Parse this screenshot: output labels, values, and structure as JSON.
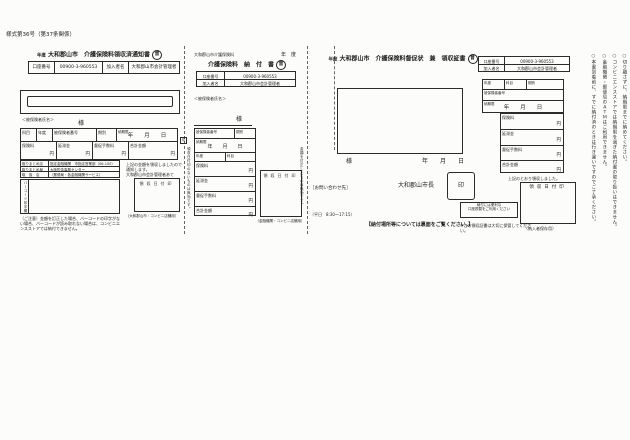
{
  "page": {
    "form_number": "様式第36号（第37条関係）"
  },
  "shared": {
    "account_label": "口座番号",
    "account_number": "00900-3-960553",
    "member_label": "加入者名",
    "member_name": "大和郡山市会計管理者",
    "insured_name_hint": "＜被保険者氏名＞",
    "honorific": "様",
    "date_placeholder": "年　　月　　日",
    "due_date_label": "納期限",
    "yen": "円",
    "field_subject": "科目",
    "field_year": "年度",
    "field_insured_no": "被保険者番号",
    "field_period": "期別",
    "amount_rows": [
      "保険料",
      "延滞金",
      "督促手数料",
      "合計金額"
    ],
    "receipt_stamp_label": "領収日付印",
    "circled_mark": "普",
    "cut_mark": "切"
  },
  "left_slip": {
    "title_year": "年度",
    "title": "大和郡山市　介護保険料領収済通知書",
    "rows": [
      {
        "label": "取りまとめ店",
        "value": "指定金融機関　市指定営業部（06-100）"
      },
      {
        "label": "取りまとめ局",
        "value": "大阪貯金事務センター"
      },
      {
        "label": "取　扱　店",
        "value": "（郵便局・各金融機関サービス）"
      }
    ],
    "barcode_label": "バーコード印字欄",
    "notify_line1": "上記の金額を領収しましたので通知します。",
    "notify_line2": "大和郡山市会計管理者あて",
    "stamp_caption": "（大和郡山市・コンビニ店舗用）",
    "note_text": "（ご注意）金額を訂正した場合、バーコードの印字がない場合、バーコードが読み取れない場合は、コンビニエンスストアでは納付できません。"
  },
  "middle_slip": {
    "header_left": "大和郡山市介護保険料",
    "header_year": "年　度",
    "title": "介護保険料　納　付　書",
    "left_side_note": "領収日付印のないものは無効です。",
    "right_side_note": "金額を訂正したものは無効です。",
    "stamp_caption": "（金融機関・コンビニ店舗用）"
  },
  "contact_info": {
    "label": "［お問い合わせ先］",
    "hours": "（平日　8:30～17:15）"
  },
  "right_slip": {
    "title_year": "年度",
    "title": "大和郡山市　介護保険料督促状　兼　領収証書",
    "mayor": "大和郡山市長",
    "seal": "印",
    "receipt_text": "上記のとおり領収しました。",
    "stamp_caption": "〈納入者保存用〉",
    "promo_line1": "納付には便利な",
    "promo_line2": "口座振替をご利用ください",
    "place_note": "【納付場所等については裏面をご覧ください。】",
    "keep_note": "※この領収証書は大切に保管してください。",
    "vertical_notes": [
      "○切り離さずに、納期限までに納めてください。",
      "○コンビニエンスストアでは納期限を過ぎた納付書の取り扱いはできません。",
      "○金融機関・郵便局のＡＴＭはご利用できません。",
      "○本書到着前に、すでに納付済のときは行き違いですのでご了承ください。"
    ]
  }
}
